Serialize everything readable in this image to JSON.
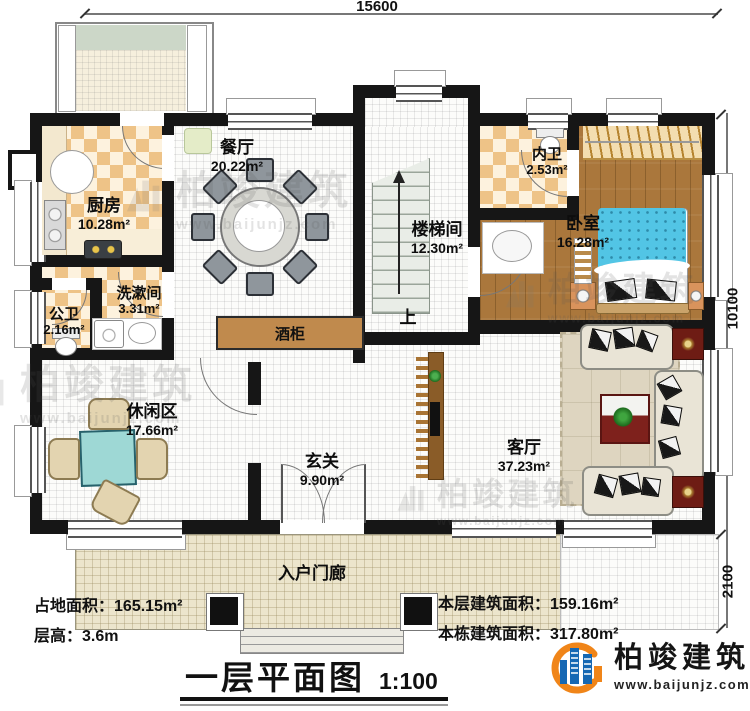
{
  "dimensions": {
    "width_top": "15600",
    "height_right": "10100",
    "porch_height": "2100"
  },
  "rooms": {
    "dining": {
      "name": "餐厅",
      "area": "20.22m²"
    },
    "kitchen": {
      "name": "厨房",
      "area": "10.28m²"
    },
    "laundry": {
      "name": "洗漱间",
      "area": "3.31m²"
    },
    "public_bath": {
      "name": "公卫",
      "area": "2.16m²"
    },
    "leisure": {
      "name": "休闲区",
      "area": "17.66m²"
    },
    "foyer": {
      "name": "玄关",
      "area": "9.90m²"
    },
    "living": {
      "name": "客厅",
      "area": "37.23m²"
    },
    "stair_hall": {
      "name": "楼梯间",
      "area": "12.30m²"
    },
    "inner_bath": {
      "name": "内卫",
      "area": "2.53m²"
    },
    "bedroom": {
      "name": "卧室",
      "area": "16.28m²"
    }
  },
  "annotations": {
    "wine_cabinet": "酒柜",
    "stair_up": "上",
    "porch": "入户门廊"
  },
  "stats": {
    "land_area_label": "占地面积：",
    "land_area_value": "165.15m²",
    "floor_height_label": "层高：",
    "floor_height_value": "3.6m",
    "this_floor_area_label": "本层建筑面积：",
    "this_floor_area_value": "159.16m²",
    "building_area_label": "本栋建筑面积：",
    "building_area_value": "317.80m²"
  },
  "title": {
    "name": "一层平面图",
    "scale": "1:100"
  },
  "brand": {
    "name": "柏竣建筑",
    "website": "www.baijunjz.com"
  },
  "colors": {
    "wall": "#161616",
    "checker_tile": "#eec387",
    "wood_floor": "#aa773c",
    "bed": "#52c5e5",
    "porch_floor": "#ece5cc",
    "accent_red": "#6e1c14",
    "brand_blue": "#1668b3",
    "brand_orange": "#f08519"
  }
}
